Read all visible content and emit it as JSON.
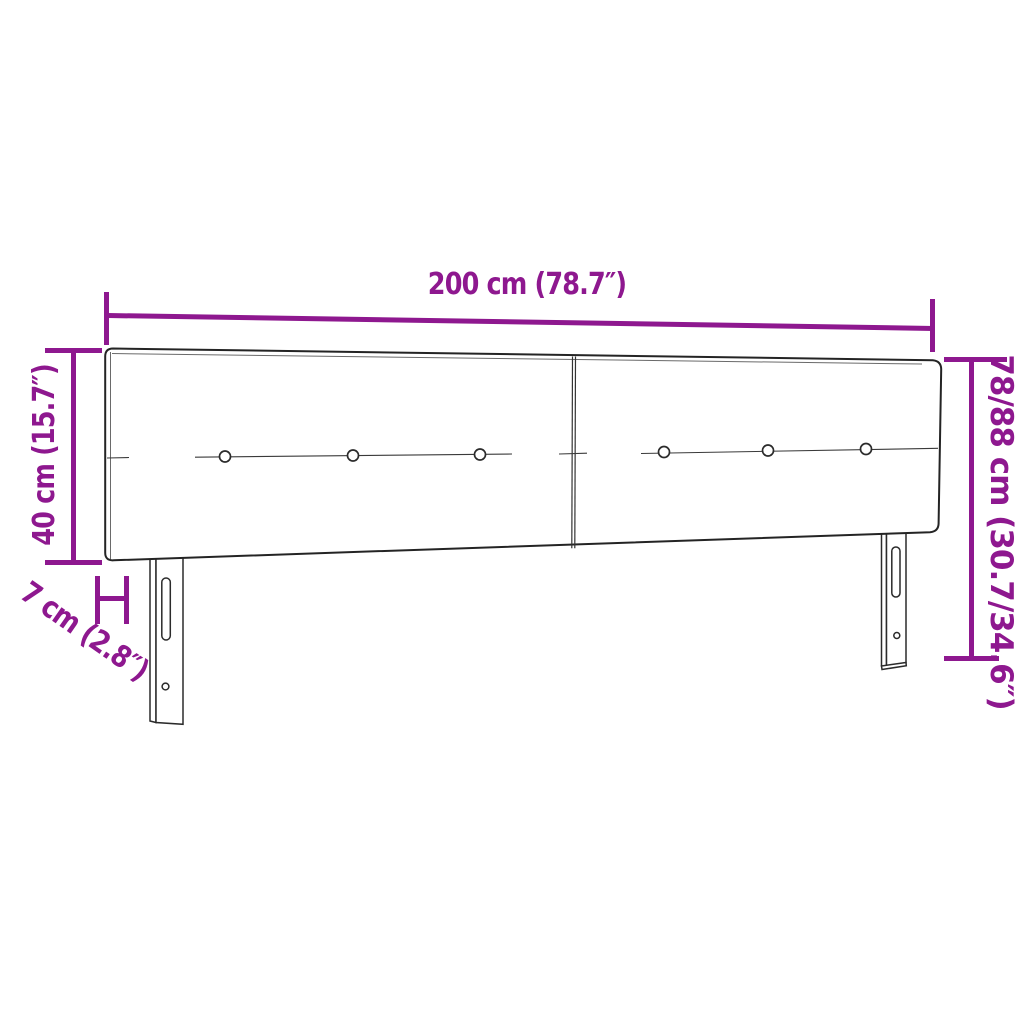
{
  "figure": {
    "product": "upholstered-headboard-diagram",
    "panels": 2,
    "buttons_per_panel": 3,
    "legs": 2,
    "leg_features": [
      "mounting-slot",
      "screw-hole"
    ]
  },
  "dimensions": {
    "width": "200 cm (78.7″)",
    "panel_height": "40 cm (15.7″)",
    "depth": "7 cm (2.8″)",
    "total_height": "78/88 cm (30.7/34.6″)"
  },
  "colors": {
    "dimension_accent": "#8E188F",
    "drawing_line": "#2b2b2b",
    "background": "#ffffff"
  }
}
